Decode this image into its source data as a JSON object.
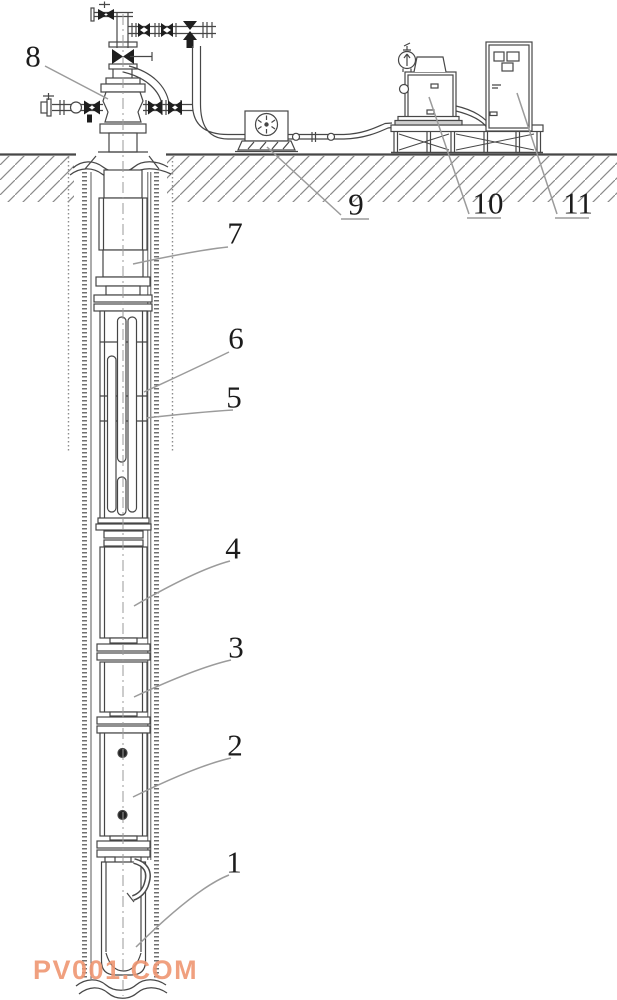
{
  "labels": [
    {
      "text": "1"
    },
    {
      "text": "2"
    },
    {
      "text": "3"
    },
    {
      "text": "4"
    },
    {
      "text": "5"
    },
    {
      "text": "6"
    },
    {
      "text": "7"
    },
    {
      "text": "8"
    },
    {
      "text": "9"
    },
    {
      "text": "10"
    },
    {
      "text": "11"
    }
  ],
  "watermark": {
    "text": "PV001.COM",
    "color": "#ef9672"
  },
  "colors": {
    "background": "#ffffff",
    "line_art": "#474747",
    "valve_fill": "#1e1e1e",
    "casing_stipple": "#707070",
    "leader_line": "#999999",
    "label_text": "#1c1c1c"
  }
}
